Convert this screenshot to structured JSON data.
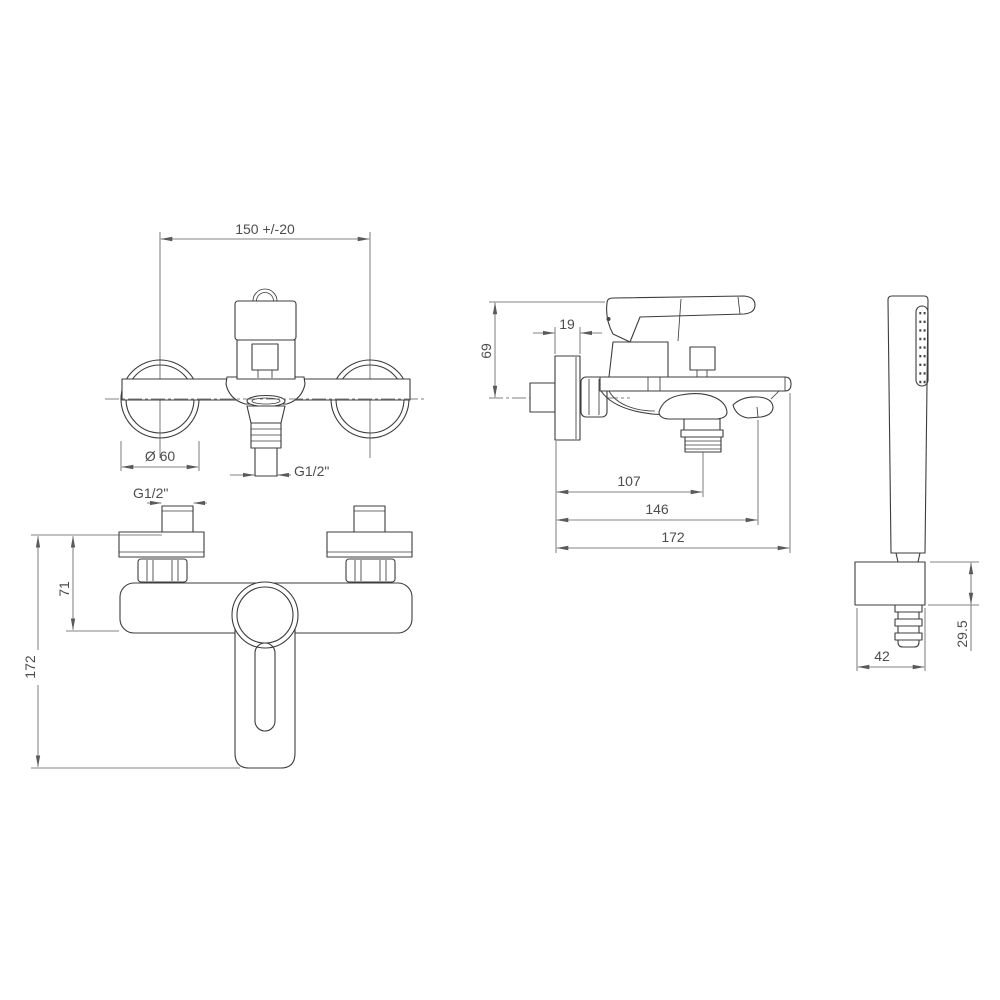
{
  "drawing": {
    "type": "technical dimensional drawing",
    "subject": "wall-mounted bath shower mixer with hand shower",
    "background_color": "#ffffff",
    "line_color": "#3c3c3c",
    "dimension_color": "#5a5a5a"
  },
  "views": {
    "front": {
      "name": "front view",
      "dim_hole_distance": "150 +/-20",
      "dim_flange_diameter": "Ø 60",
      "dim_spout_thread": "G1/2\""
    },
    "bottom": {
      "name": "bottom view",
      "dim_inlet_thread": "G1/2\"",
      "dim_body_depth": "71",
      "dim_total_depth": "172"
    },
    "side": {
      "name": "side view",
      "dim_flange_thickness": "19",
      "dim_lever_height": "69",
      "dim_spout_reach": "107",
      "dim_shower_outlet_reach": "146",
      "dim_total_reach": "172"
    },
    "hand_shower": {
      "name": "hand shower view",
      "dim_bracket_width": "42",
      "dim_bracket_height": "29.5"
    }
  }
}
